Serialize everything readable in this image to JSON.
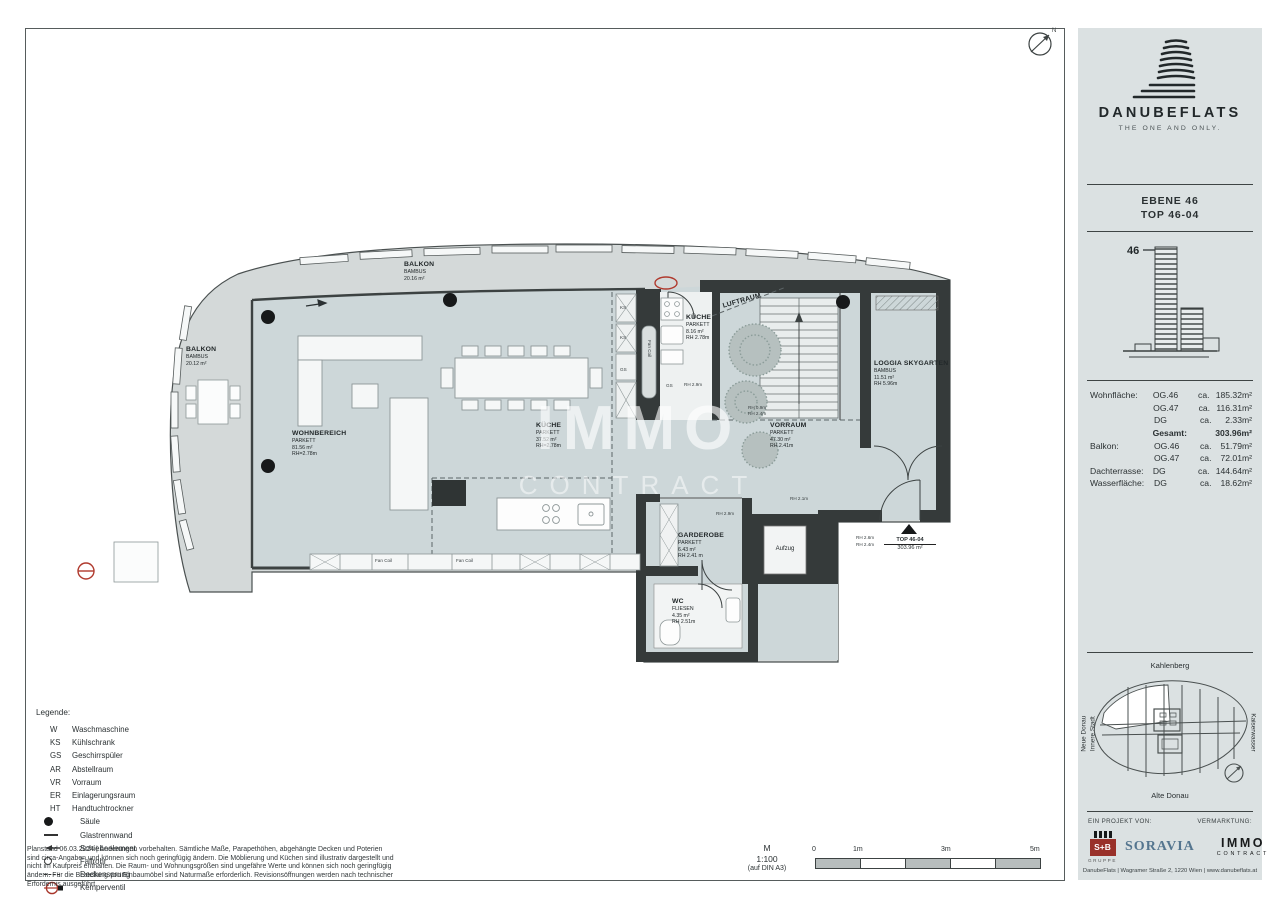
{
  "sheet": {
    "north": "N",
    "watermark": {
      "line1": "IMMO",
      "line2": "CONTRACT"
    },
    "scale": {
      "m_label": "M",
      "ratio": "1:100",
      "paper": "(auf DIN A3)",
      "ticks": [
        "0",
        "1m",
        "3m",
        "5m"
      ]
    },
    "legend": {
      "title": "Legende:",
      "abbrev": [
        {
          "key": "W",
          "label": "Waschmaschine"
        },
        {
          "key": "KS",
          "label": "Kühlschrank"
        },
        {
          "key": "GS",
          "label": "Geschirrspüler"
        },
        {
          "key": "AR",
          "label": "Abstellraum"
        },
        {
          "key": "VR",
          "label": "Vorraum"
        },
        {
          "key": "ER",
          "label": "Einlagerungsraum"
        },
        {
          "key": "HT",
          "label": "Handtuchtrockner"
        }
      ],
      "symbols": [
        {
          "label": "Säule"
        },
        {
          "label": "Glastrennwand"
        },
        {
          "label": "Schiebeelement"
        },
        {
          "label": "Fallrohr"
        },
        {
          "label": "Deckensprung"
        },
        {
          "label": "Kemperventil"
        }
      ]
    },
    "disclaimer": "Planstand 06.03.2024 | Änderungen vorbehalten. Sämtliche Maße, Parapethöhen, abgehängte Decken und Poterien sind circa-Angaben und können sich noch geringfügig ändern. Die Möblierung und Küchen sind illustrativ dargestellt und nicht im Kaufpreis enthalten. Die Raum- und Wohnungsgrößen sind ungefähre Werte und können sich noch geringfügig ändern. Für die Bestellung von Einbaumöbel sind Naturmaße erforderlich. Revisionsöffnungen werden nach technischer Erfordernis ausgeführt."
  },
  "plan": {
    "rooms": {
      "balkonLeft": {
        "name": "BALKON",
        "sub": "BAMBUS\n20.12 m²"
      },
      "balkonTop": {
        "name": "BALKON",
        "sub": "BAMBUS\n20.16 m²"
      },
      "kuecheTop": {
        "name": "KÜCHE",
        "sub": "PARKETT\n8.16 m²\nRH 2.78m"
      },
      "luftraum": {
        "name": "LUFTRAUM"
      },
      "loggia": {
        "name": "LOGGIA SKYGARTEN",
        "sub": "BAMBUS\n11.51 m²\nRH 5.96m"
      },
      "wohnbereich": {
        "name": "WOHNBEREICH",
        "sub": "PARKETT\n81.56 m²\nRH=2.78m"
      },
      "kuecheMain": {
        "name": "KÜCHE",
        "sub": "PARKETT\n37.52 m²\nRH=2.78m"
      },
      "vorraum": {
        "name": "VORRAUM",
        "sub": "PARKETT\n47.30 m²\nRH 2.41m"
      },
      "garderobe": {
        "name": "GARDEROBE",
        "sub": "PARKETT\n6.43 m²\nRH 2.41 m"
      },
      "wc": {
        "name": "WC",
        "sub": "FLIESEN\n4.35 m²\nRH 2.51m"
      },
      "aufzug": {
        "name": "Aufzug"
      }
    },
    "entrance": {
      "top": "TOP 46-04",
      "area": "303.96 m²"
    },
    "small": {
      "fancoil": "Fan Coil",
      "ks": "KS",
      "gs": "GS",
      "rh29": "RH 2.9m",
      "rh09": "RH 0.9m",
      "rh24": "RH 2.4m",
      "rh21": "RH 2.1m",
      "rh26": "RH 2.6m"
    }
  },
  "panel": {
    "brand": {
      "name": "DANUBEFLATS",
      "tagline": "THE ONE AND ONLY."
    },
    "unit": {
      "level": "EBENE 46",
      "top": "TOP 46-04"
    },
    "elevation": {
      "floor": "46"
    },
    "areas": {
      "rows": [
        {
          "label": "Wohnfläche:",
          "level": "OG.46",
          "ca": "ca.",
          "value": "185.32m²"
        },
        {
          "label": "",
          "level": "OG.47",
          "ca": "ca.",
          "value": "116.31m²"
        },
        {
          "label": "",
          "level": "DG",
          "ca": "ca.",
          "value": "2.33m²"
        },
        {
          "label": "",
          "level": "Gesamt:",
          "ca": "",
          "value": "303.96m²"
        },
        {
          "label": "Balkon:",
          "level": "OG.46",
          "ca": "ca.",
          "value": "51.79m²"
        },
        {
          "label": "",
          "level": "OG.47",
          "ca": "ca.",
          "value": "72.01m²"
        },
        {
          "label": "Dachterrasse:",
          "level": "DG",
          "ca": "ca.",
          "value": "144.64m²"
        },
        {
          "label": "Wasserfläche:",
          "level": "DG",
          "ca": "ca.",
          "value": "18.62m²"
        }
      ]
    },
    "keyplan": {
      "top": "Kahlenberg",
      "left1": "Neue Donau",
      "left2": "Innere Stadt",
      "right": "Kaiserwasser",
      "bottom": "Alte Donau"
    },
    "footer": {
      "project_label": "EIN PROJEKT VON:",
      "marketing_label": "VERMARKTUNG:",
      "sb": "S+B",
      "sb_sub": "GRUPPE",
      "soravia": "SORAVIA",
      "immo": "IMMO",
      "immo_sub": "CONTRACT",
      "address": "DanubeFlats   |   Wagramer Straße 2, 1220 Wien   |   www.danubeflats.at"
    }
  }
}
